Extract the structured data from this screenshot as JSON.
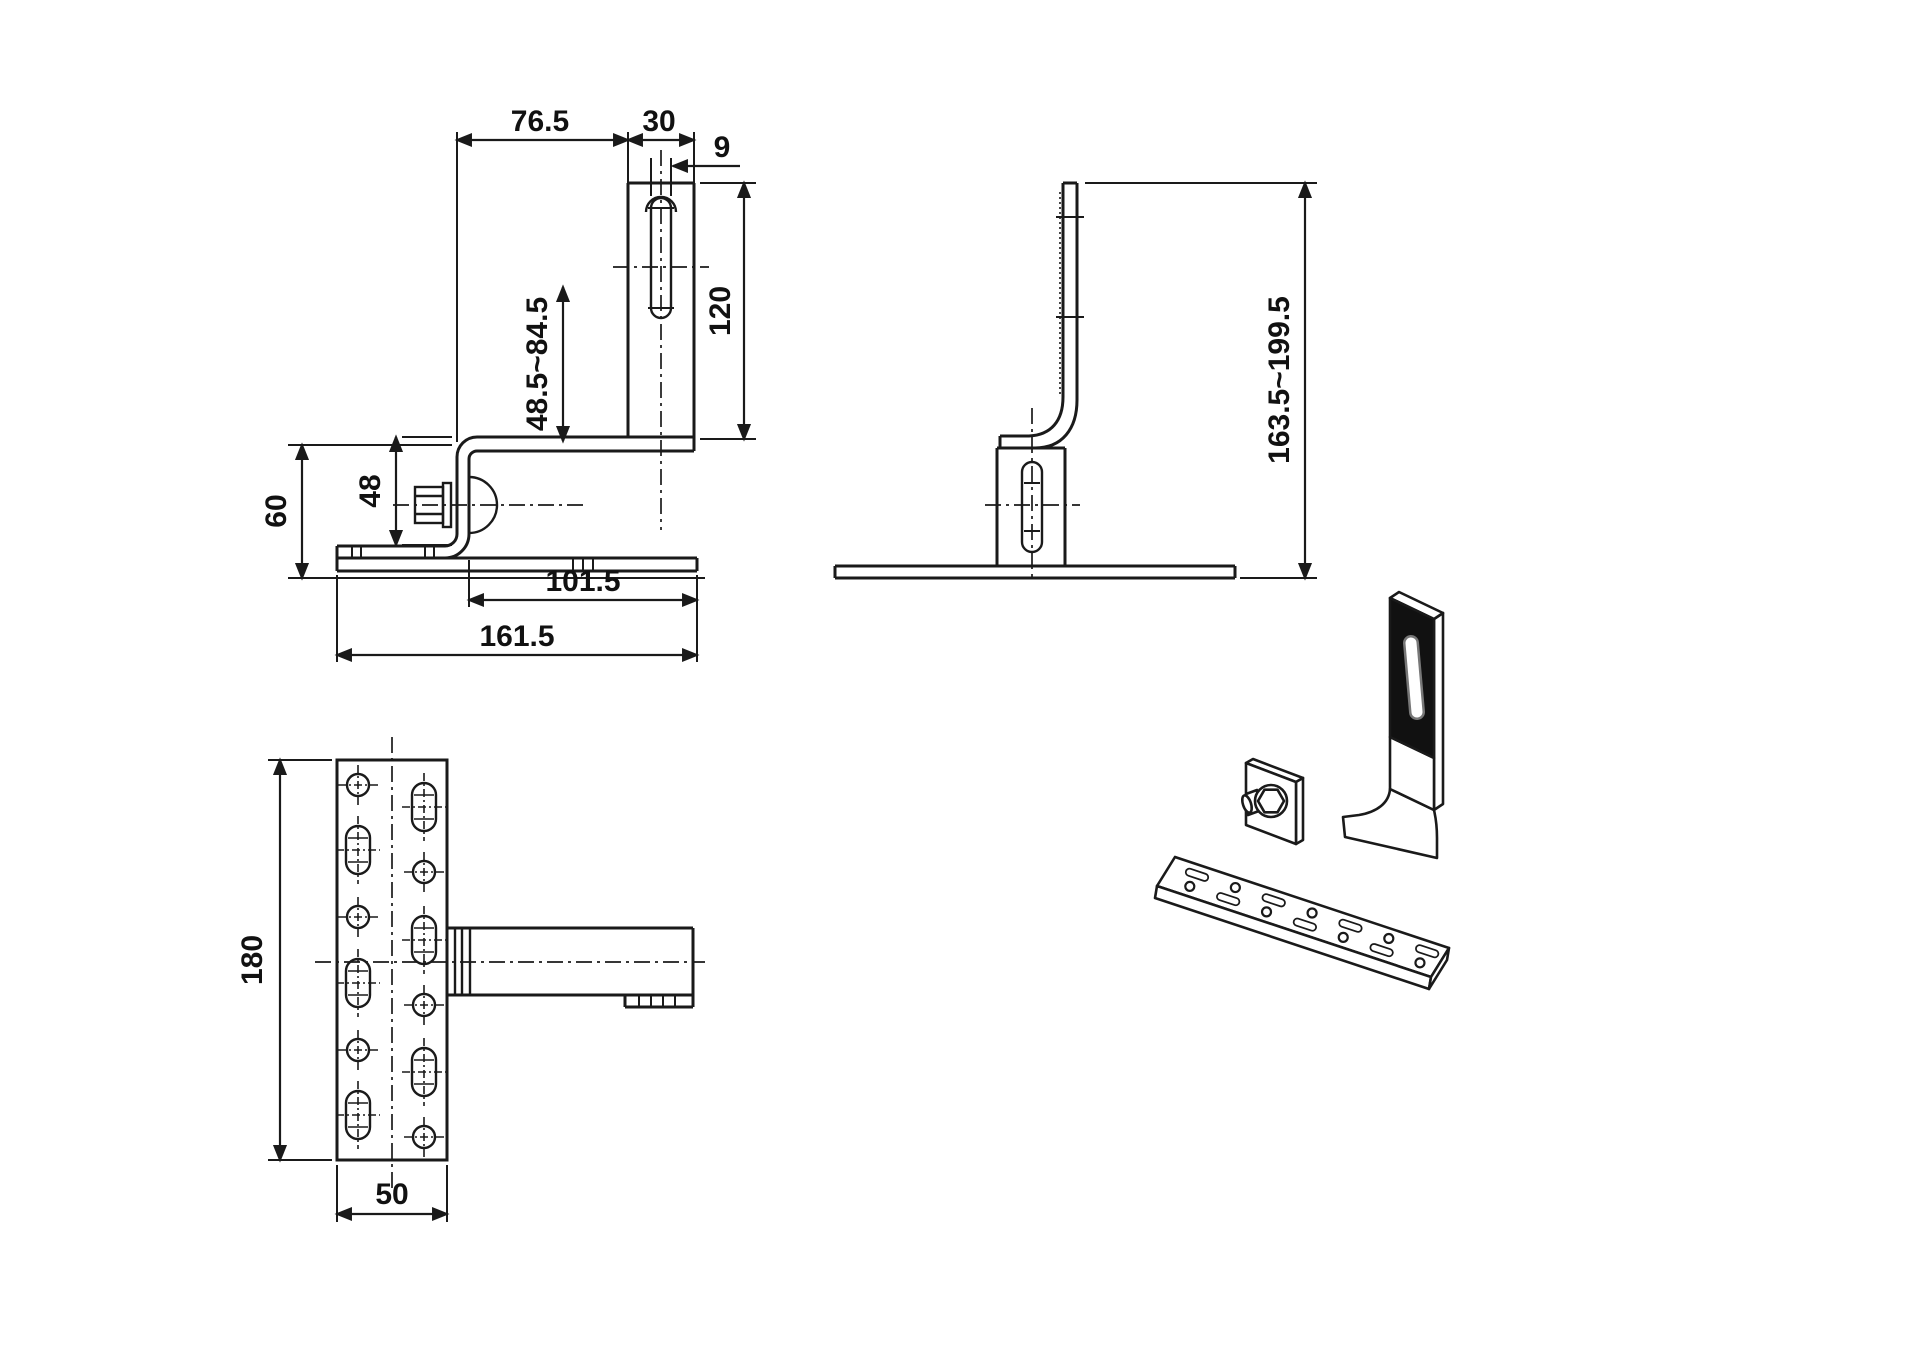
{
  "title": "roof-hook-technical-drawing",
  "colors": {
    "line": "#1a1a1a",
    "fill_dark": "#111111",
    "background": "#ffffff"
  },
  "views": {
    "front": {
      "dims": {
        "top_width": "76.5",
        "strap_width": "30",
        "slot_width": "9",
        "strap_length": "120",
        "adjust_range": "48.5~84.5",
        "clamp_height": "48",
        "base_height": "60",
        "foot_length": "101.5",
        "overall_length": "161.5"
      }
    },
    "side": {
      "dims": {
        "height_range": "163.5~199.5"
      }
    },
    "plan": {
      "dims": {
        "plate_length": "180",
        "plate_width": "50"
      }
    }
  }
}
